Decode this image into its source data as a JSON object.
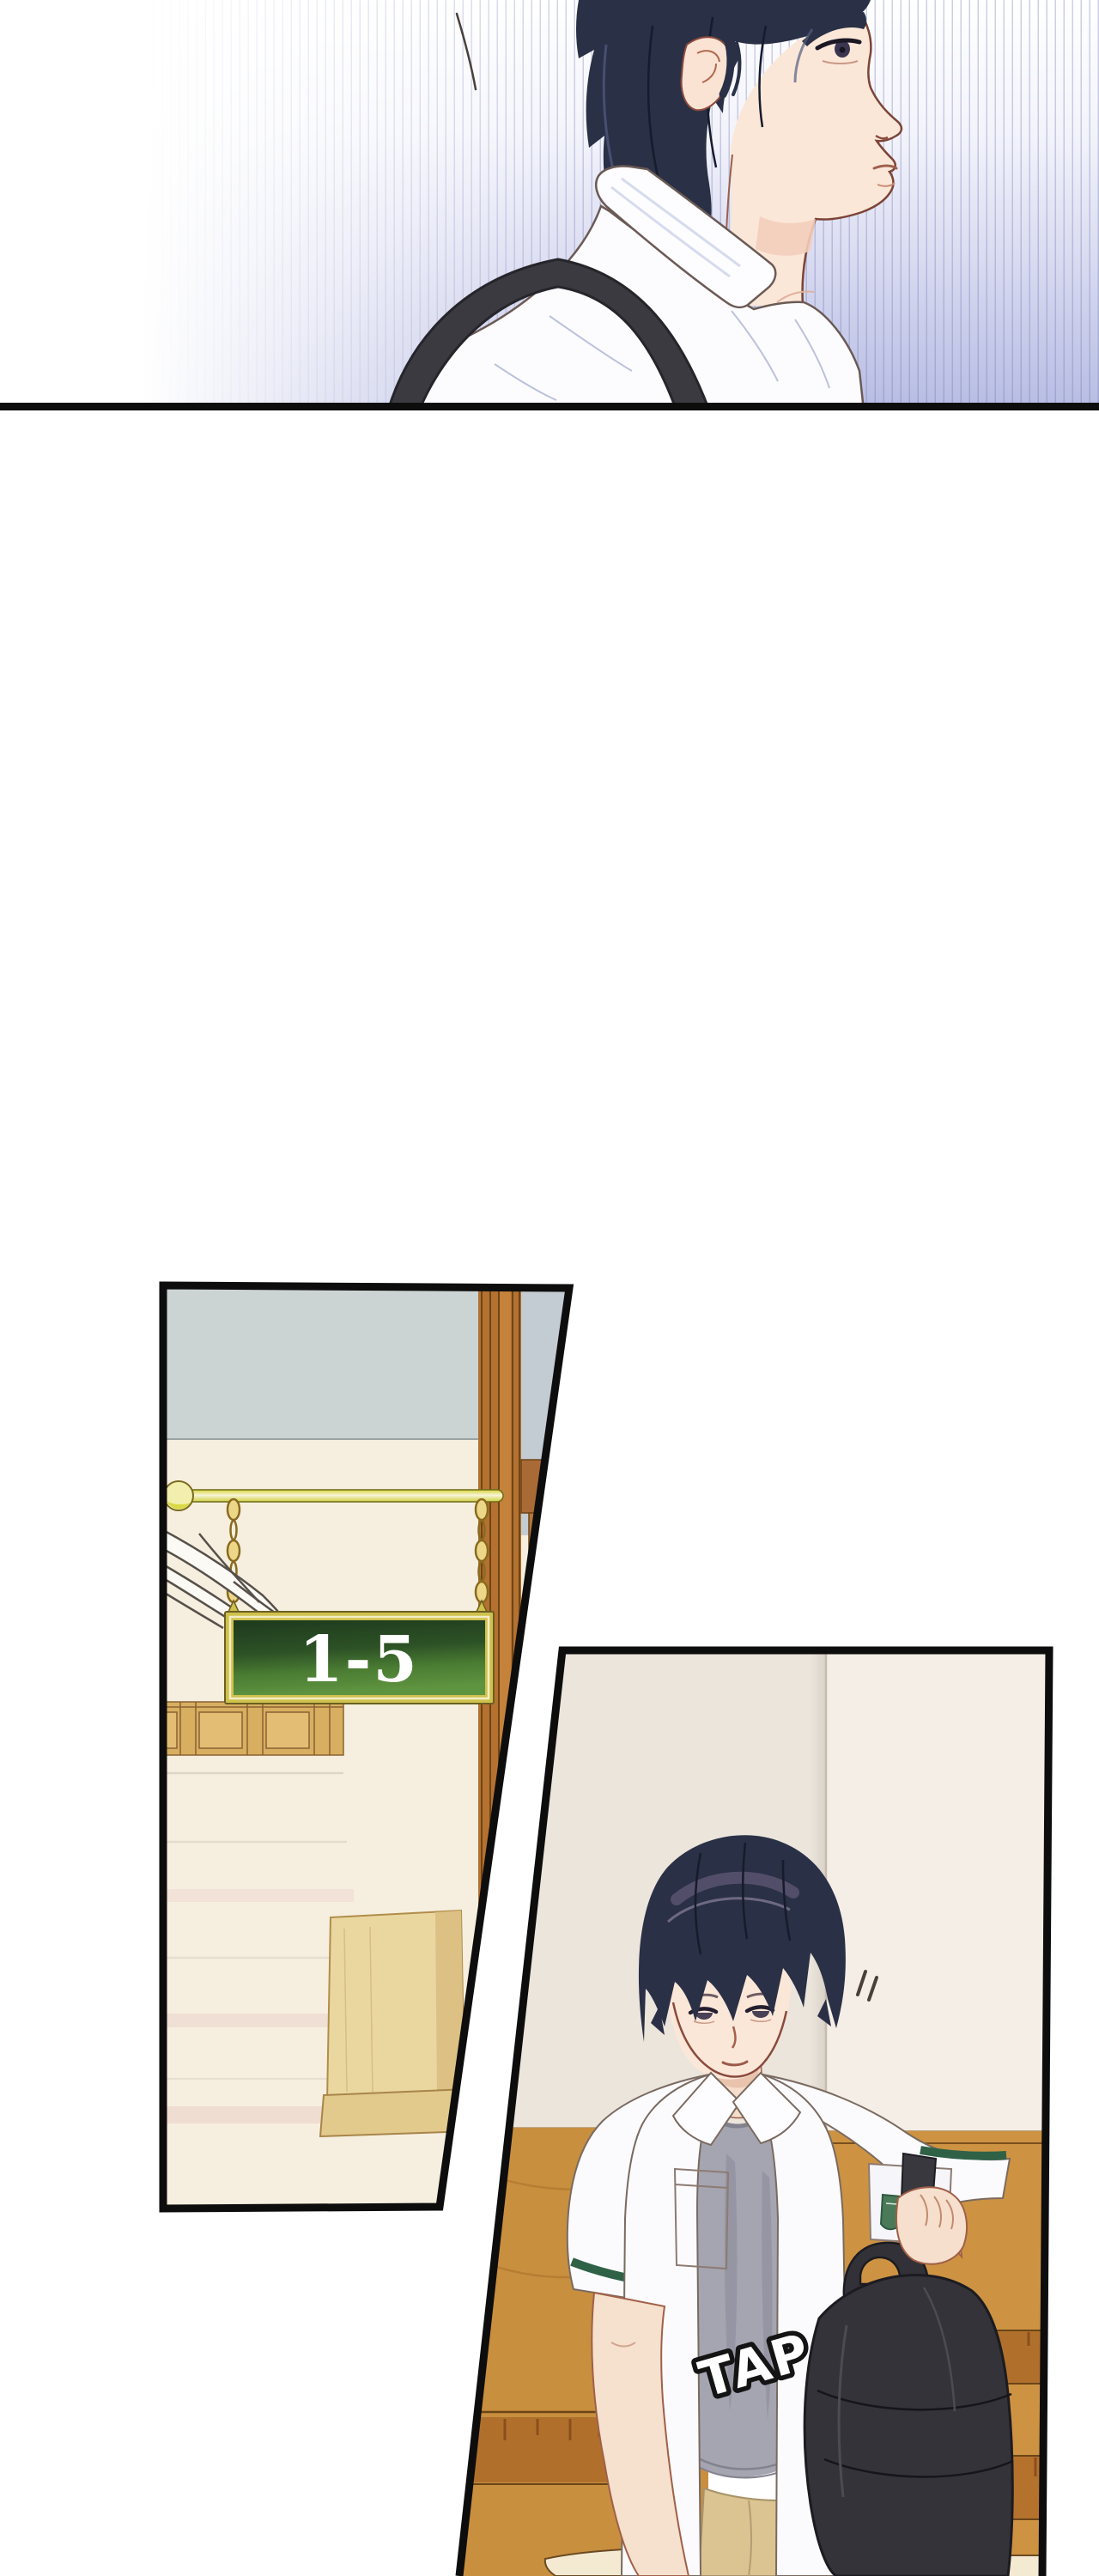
{
  "sign": {
    "label": "1-5"
  },
  "sfx": {
    "label": "TAP",
    "rotation_deg": -16
  },
  "palette": {
    "page_background": "#ffffff",
    "panel_border": "#0e0d0d",
    "stripe_lavender": "#b7bce3",
    "hair_navy": "#2a3045",
    "hair_sheen_purple": "#7a6b8d",
    "skin": "#fbe7d8",
    "skin_line": "#8a4a3c",
    "shirt_white": "#fcfcfe",
    "shirt_shadow_lavender": "#ccd2ea",
    "strap_black": "#3b3a40",
    "tee_gray": "#a5a5b1",
    "cuff_stripe_green": "#2f6147",
    "backpack_black": "#34333a",
    "pants_khaki": "#dbc491",
    "ceiling_gray": "#ccd3d3",
    "sky_gray_blue": "#c3ccd3",
    "wall_cream": "#f6efdf",
    "wall_cream_right_panel": "#f4eee6",
    "wood_brown": "#b4712f",
    "wood_dark_line": "#6e4518",
    "door_tan": "#d8ae61",
    "pole_yellow": "#e0de3e",
    "pole_highlight": "#f7f5d8",
    "chain_gold": "#ecd789",
    "sign_frame_gold": "#cfc14d",
    "sign_green_top": "#1e3a1d",
    "sign_green_bottom": "#5e9340",
    "sign_text_color": "#ffffff",
    "stair_wood": "#cd9342",
    "stair_face_wood": "#b0702c",
    "newel_wood": "#ead7a0",
    "step_shadow_pink": "#f2e2d8"
  }
}
